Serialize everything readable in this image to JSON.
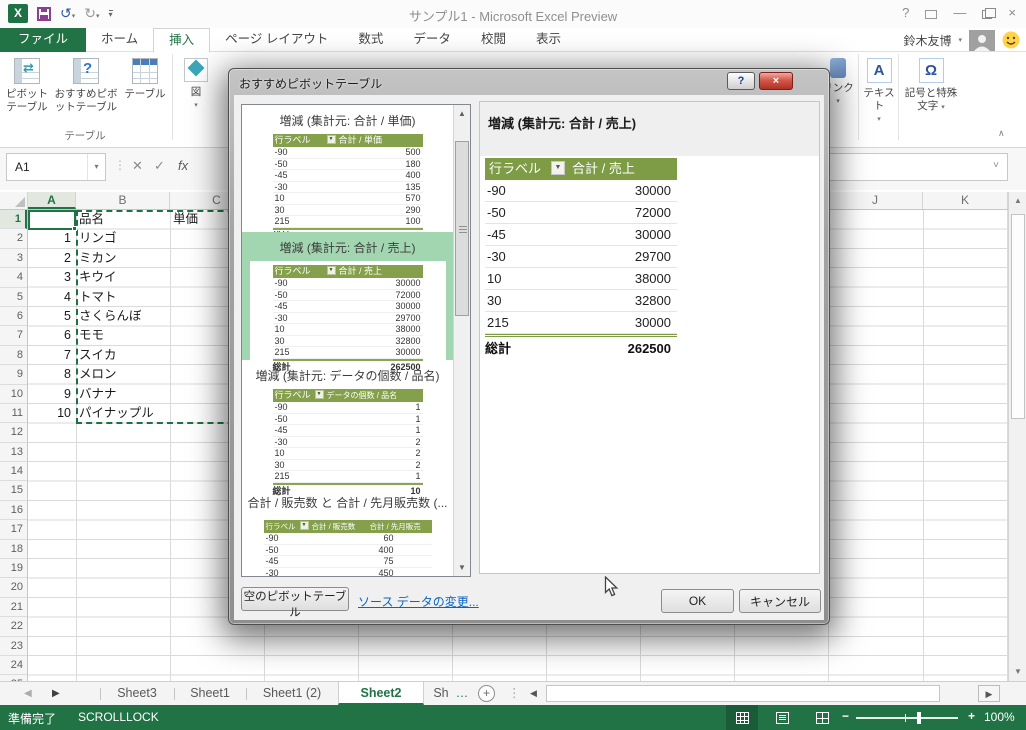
{
  "window": {
    "title": "サンプル1 - Microsoft Excel Preview"
  },
  "icons": {
    "excel_logo": "X",
    "undo": "↺",
    "redo": "↻",
    "dropdown": "▾",
    "help": "?",
    "minimize": "—",
    "close": "×",
    "cancel_x": "✕",
    "check": "✓",
    "fx": "fx",
    "up": "▲",
    "down": "▼",
    "left": "◀",
    "right": "▶",
    "ellipsis_v": "⋮",
    "chevron_down": "˅",
    "collapse": "∧",
    "more": "…",
    "add": "+",
    "omega": "Ω",
    "text_a": "A",
    "zoom_out": "−",
    "zoom_in": "+"
  },
  "colors": {
    "excel_green": "#217346",
    "pivot_header_olive": "#7e9c45",
    "selected_item_green": "#a2d6b0"
  },
  "ribbon": {
    "tabs": [
      "ファイル",
      "ホーム",
      "挿入",
      "ページ レイアウト",
      "数式",
      "データ",
      "校閲",
      "表示"
    ],
    "active_tab": "挿入",
    "user_name": "鈴木友博",
    "buttons": {
      "pivot": "ピボットテーブル",
      "recommended": "おすすめピボットテーブル",
      "table": "テーブル",
      "group_table_label": "テーブル",
      "illustrations": "図",
      "link": "リンク",
      "text": "テキスト",
      "symbols": "記号と特殊文字"
    }
  },
  "formula_bar": {
    "name_box": "A1"
  },
  "grid": {
    "left_columns": [
      "A",
      "B",
      "C"
    ],
    "right_columns": [
      "J",
      "K"
    ],
    "row_numbers": [
      "1",
      "2",
      "3",
      "4",
      "5",
      "6",
      "7",
      "8",
      "9",
      "10",
      "11",
      "12",
      "13",
      "14",
      "15",
      "16",
      "17",
      "18",
      "19",
      "20",
      "21",
      "22",
      "23",
      "24",
      "25"
    ],
    "header_row": {
      "b": "品名",
      "c": "単価"
    },
    "rows": [
      {
        "a": "1",
        "b": "リンゴ",
        "c": "¥19"
      },
      {
        "a": "2",
        "b": "ミカン",
        "c": "¥8"
      },
      {
        "a": "3",
        "b": "キウイ",
        "c": "¥7"
      },
      {
        "a": "4",
        "b": "トマト",
        "c": "¥6"
      },
      {
        "a": "5",
        "b": "さくらんぼ",
        "c": "¥10"
      },
      {
        "a": "6",
        "b": "モモ",
        "c": "¥2"
      },
      {
        "a": "7",
        "b": "スイカ",
        "c": "¥40"
      },
      {
        "a": "8",
        "b": "メロン",
        "c": "¥50"
      },
      {
        "a": "9",
        "b": "バナナ",
        "c": "¥18"
      },
      {
        "a": "10",
        "b": "パイナップル",
        "c": "¥38"
      }
    ]
  },
  "dialog": {
    "title": "おすすめピボットテーブル",
    "list": [
      {
        "title": "増減 (集計元: 合計 / 単価)",
        "header": {
          "label": "行ラベル",
          "value": "合計 / 単価"
        },
        "rows": [
          [
            "-90",
            "500"
          ],
          [
            "-50",
            "180"
          ],
          [
            "-45",
            "400"
          ],
          [
            "-30",
            "135"
          ],
          [
            "10",
            "570"
          ],
          [
            "30",
            "290"
          ],
          [
            "215",
            "100"
          ]
        ],
        "total": {
          "label": "総計",
          "value": "2175"
        }
      },
      {
        "title": "増減 (集計元: 合計 / 売上)",
        "header": {
          "label": "行ラベル",
          "value": "合計 / 売上"
        },
        "rows": [
          [
            "-90",
            "30000"
          ],
          [
            "-50",
            "72000"
          ],
          [
            "-45",
            "30000"
          ],
          [
            "-30",
            "29700"
          ],
          [
            "10",
            "38000"
          ],
          [
            "30",
            "32800"
          ],
          [
            "215",
            "30000"
          ]
        ],
        "total": {
          "label": "総計",
          "value": "262500"
        }
      },
      {
        "title": "増減 (集計元: データの個数 / 品名)",
        "header": {
          "label": "行ラベル",
          "value": "データの個数 / 品名"
        },
        "rows": [
          [
            "-90",
            "1"
          ],
          [
            "-50",
            "1"
          ],
          [
            "-45",
            "1"
          ],
          [
            "-30",
            "2"
          ],
          [
            "10",
            "2"
          ],
          [
            "30",
            "2"
          ],
          [
            "215",
            "1"
          ]
        ],
        "total": {
          "label": "総計",
          "value": "10"
        }
      },
      {
        "title": "合計 / 販売数 と 合計 / 先月販売数 (...",
        "header": {
          "label": "行ラベル",
          "value": "合計 / 販売数",
          "value2": "合計 / 先月販売"
        },
        "rows": [
          [
            "-90",
            "60"
          ],
          [
            "-50",
            "400"
          ],
          [
            "-45",
            "75"
          ],
          [
            "-30",
            "450"
          ],
          [
            "10",
            "150"
          ],
          [
            "30",
            "280"
          ]
        ]
      }
    ],
    "preview": {
      "title": "増減 (集計元: 合計 / 売上)",
      "header": {
        "label": "行ラベル",
        "value": "合計 / 売上"
      },
      "rows": [
        [
          "-90",
          "30000"
        ],
        [
          "-50",
          "72000"
        ],
        [
          "-45",
          "30000"
        ],
        [
          "-30",
          "29700"
        ],
        [
          "10",
          "38000"
        ],
        [
          "30",
          "32800"
        ],
        [
          "215",
          "30000"
        ]
      ],
      "total": {
        "label": "総計",
        "value": "262500"
      }
    },
    "buttons": {
      "blank": "空のピボットテーブル",
      "change_source": "ソース データの変更...",
      "ok": "OK",
      "cancel": "キャンセル"
    }
  },
  "sheet_tabs": {
    "items": [
      "Sheet3",
      "Sheet1",
      "Sheet1 (2)",
      "Sheet2",
      "Sh"
    ],
    "active": "Sheet2"
  },
  "status_bar": {
    "ready": "準備完了",
    "scroll_lock": "SCROLLLOCK",
    "zoom_level": "100%"
  }
}
